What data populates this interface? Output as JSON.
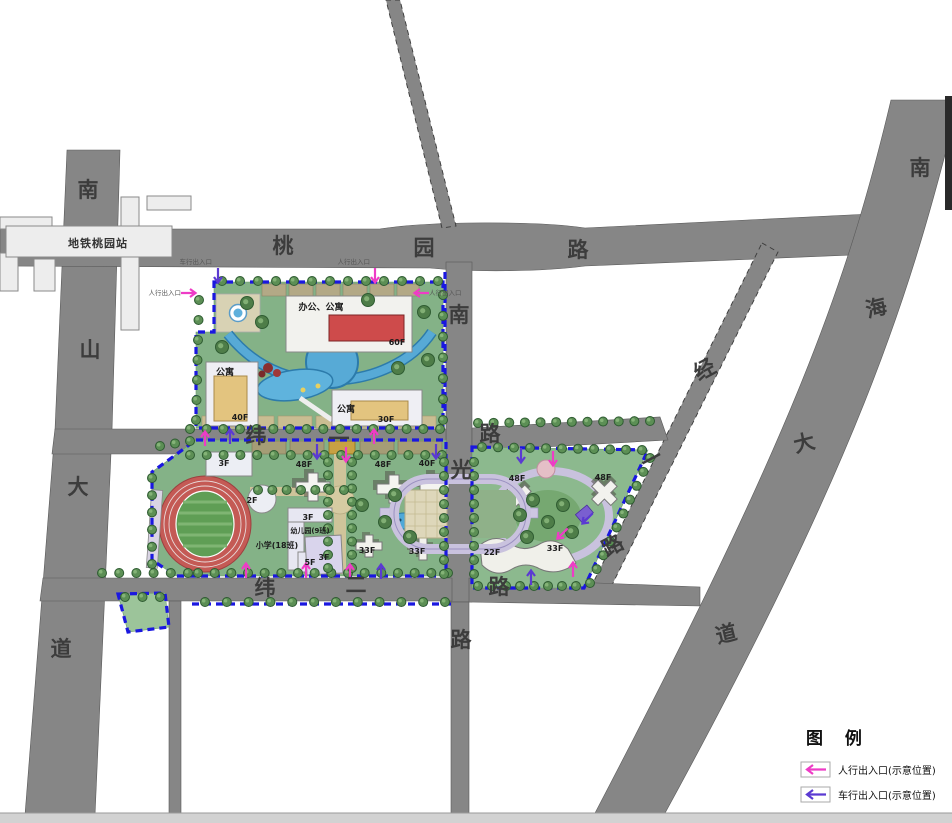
{
  "station": {
    "label": "地铁桃园站"
  },
  "roads": {
    "taoyuan_lu": {
      "name": "桃园路",
      "chars": [
        "桃",
        "园",
        "路"
      ]
    },
    "nanshan_dadao": {
      "name": "南山大道",
      "chars": [
        "南",
        "山",
        "大",
        "道"
      ]
    },
    "nanhai_dadao": {
      "name": "南海大道",
      "chars": [
        "南",
        "海",
        "大",
        "道"
      ]
    },
    "nanguang_lu": {
      "name": "南光路",
      "chars": [
        "南",
        "光",
        "路"
      ]
    },
    "wei_yi_lu": {
      "name": "纬一路",
      "chars": [
        "纬",
        "一",
        "路"
      ]
    },
    "wei_er_lu": {
      "name": "纬二路",
      "chars": [
        "纬",
        "二",
        "路"
      ]
    },
    "jing_yi_lu": {
      "name": "经一路",
      "chars": [
        "经",
        "一",
        "路"
      ]
    }
  },
  "parcels": {
    "north": {
      "office_apartment_label": "办公、公寓",
      "office_floors": "60F",
      "apartment_left_label": "公寓",
      "apartment_left_floors": "40F",
      "apartment_right_label": "公寓",
      "apartment_right_floors": "30F"
    },
    "middle": {
      "school_label": "小学(18班)",
      "kindergarten_label": "幼儿园(9班)",
      "school_floors_a": "3F",
      "school_floors_b": "2F",
      "school_floors_c": "3F",
      "school_floors_d": "5F",
      "kindergarten_floors": "3F",
      "tower_floors": [
        "48F",
        "48F",
        "40F",
        "33F",
        "33F"
      ]
    },
    "east": {
      "tower_floors": [
        "48F",
        "48F",
        "22F",
        "33F"
      ]
    }
  },
  "entrances": {
    "pedestrian_label": "人行出入口",
    "vehicle_label": "车行出入口",
    "arrows": [
      {
        "kind": "vehicle",
        "x": 218,
        "y": 276,
        "dir": "down"
      },
      {
        "kind": "pedestrian",
        "x": 375,
        "y": 276,
        "dir": "down"
      },
      {
        "kind": "pedestrian",
        "x": 189,
        "y": 293,
        "dir": "right"
      },
      {
        "kind": "pedestrian",
        "x": 421,
        "y": 293,
        "dir": "left"
      },
      {
        "kind": "pedestrian",
        "x": 205,
        "y": 438,
        "dir": "up"
      },
      {
        "kind": "vehicle",
        "x": 230,
        "y": 436,
        "dir": "up"
      },
      {
        "kind": "vehicle",
        "x": 317,
        "y": 452,
        "dir": "down"
      },
      {
        "kind": "pedestrian",
        "x": 346,
        "y": 455,
        "dir": "down"
      },
      {
        "kind": "pedestrian",
        "x": 374,
        "y": 436,
        "dir": "up"
      },
      {
        "kind": "vehicle",
        "x": 436,
        "y": 452,
        "dir": "down"
      },
      {
        "kind": "pedestrian",
        "x": 246,
        "y": 570,
        "dir": "up"
      },
      {
        "kind": "pedestrian",
        "x": 306,
        "y": 570,
        "dir": "up"
      },
      {
        "kind": "pedestrian",
        "x": 350,
        "y": 571,
        "dir": "up"
      },
      {
        "kind": "vehicle",
        "x": 381,
        "y": 571,
        "dir": "up"
      },
      {
        "kind": "vehicle",
        "x": 531,
        "y": 577,
        "dir": "up"
      },
      {
        "kind": "pedestrian",
        "x": 573,
        "y": 569,
        "dir": "up"
      },
      {
        "kind": "vehicle",
        "x": 521,
        "y": 456,
        "dir": "down"
      },
      {
        "kind": "pedestrian",
        "x": 553,
        "y": 459,
        "dir": "down"
      },
      {
        "kind": "vehicle",
        "x": 587,
        "y": 519,
        "dir": "sw"
      },
      {
        "kind": "pedestrian",
        "x": 562,
        "y": 534,
        "dir": "sw"
      }
    ]
  },
  "legend": {
    "title": "图  例",
    "items": [
      {
        "label": "人行出入口(示意位置)",
        "kind": "pedestrian"
      },
      {
        "label": "车行出入口(示意位置)",
        "kind": "vehicle"
      }
    ]
  },
  "colors": {
    "road": "#868686",
    "site_boundary_blue": "#1a17e0",
    "pedestrian_arrow": "#ee3cc6",
    "vehicle_arrow": "#5b3ad2",
    "lawn_green": "#85b288",
    "water_blue": "#57aad6",
    "track_red": "#c45a55",
    "building_red": "#ce4b4b",
    "building_yellow": "#e3c47f"
  }
}
